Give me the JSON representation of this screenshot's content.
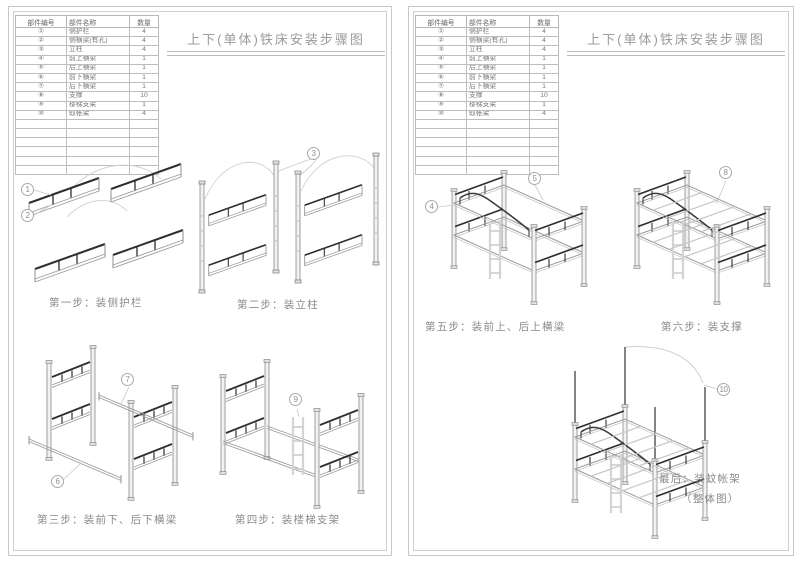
{
  "doc": {
    "title": "上下(单体)铁床安装步骤图"
  },
  "parts_table": {
    "headers": [
      "部件编号",
      "部件名称",
      "数量"
    ],
    "rows": [
      {
        "no": "①",
        "name": "侧护栏",
        "qty": "4"
      },
      {
        "no": "②",
        "name": "侧横梁(有孔)",
        "qty": "4"
      },
      {
        "no": "③",
        "name": "立柱",
        "qty": "4"
      },
      {
        "no": "④",
        "name": "前上横梁",
        "qty": "1"
      },
      {
        "no": "⑤",
        "name": "后上横梁",
        "qty": "1"
      },
      {
        "no": "⑥",
        "name": "前下横梁",
        "qty": "1"
      },
      {
        "no": "⑦",
        "name": "后下横梁",
        "qty": "1"
      },
      {
        "no": "⑧",
        "name": "支撑",
        "qty": "10"
      },
      {
        "no": "⑨",
        "name": "楼梯支架",
        "qty": "1"
      },
      {
        "no": "⑩",
        "name": "蚊帐架",
        "qty": "4"
      }
    ],
    "empty_row_count": 6
  },
  "callouts": {
    "c1": "1",
    "c2": "2",
    "c3": "3",
    "c4": "4",
    "c5": "5",
    "c6": "6",
    "c7": "7",
    "c8": "8",
    "c9": "9",
    "c10": "10"
  },
  "pages": [
    {
      "steps": [
        {
          "caption": "第一步：装侧护栏"
        },
        {
          "caption": "第二步：装立柱"
        },
        {
          "caption": "第三步：装前下、后下横梁"
        },
        {
          "caption": "第四步：装楼梯支架"
        }
      ]
    },
    {
      "steps": [
        {
          "caption": "第五步：装前上、后上横梁"
        },
        {
          "caption": "第六步：装支撑"
        },
        {
          "caption": "最后：装蚊帐架",
          "caption2": "（整体图）"
        }
      ]
    }
  ]
}
